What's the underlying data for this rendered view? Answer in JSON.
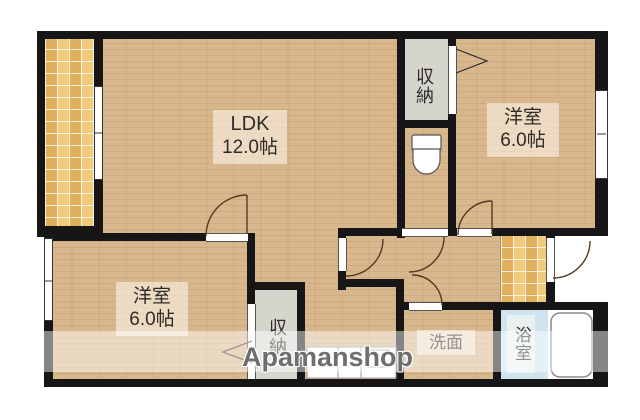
{
  "plan": {
    "rooms": {
      "ldk": {
        "name": "LDK",
        "size": "12.0帖"
      },
      "bedroom_right": {
        "name": "洋室",
        "size": "6.0帖"
      },
      "bedroom_left": {
        "name": "洋室",
        "size": "6.0帖"
      },
      "closet_top": {
        "name": "収納"
      },
      "closet_bottom": {
        "name": "収納"
      },
      "washroom": {
        "name": "洗面"
      },
      "bathroom": {
        "name": "浴室"
      }
    },
    "watermark": "Apamanshop",
    "colors": {
      "wood_floor": "#d9b78d",
      "tile_floor": "#e9bd6a",
      "wall": "#161616",
      "closet_fill": "#d6d5cd",
      "bath_fill": "#cfe4ef",
      "label_text": "#2f2c28",
      "watermark_text": "#6e6e6e"
    }
  }
}
